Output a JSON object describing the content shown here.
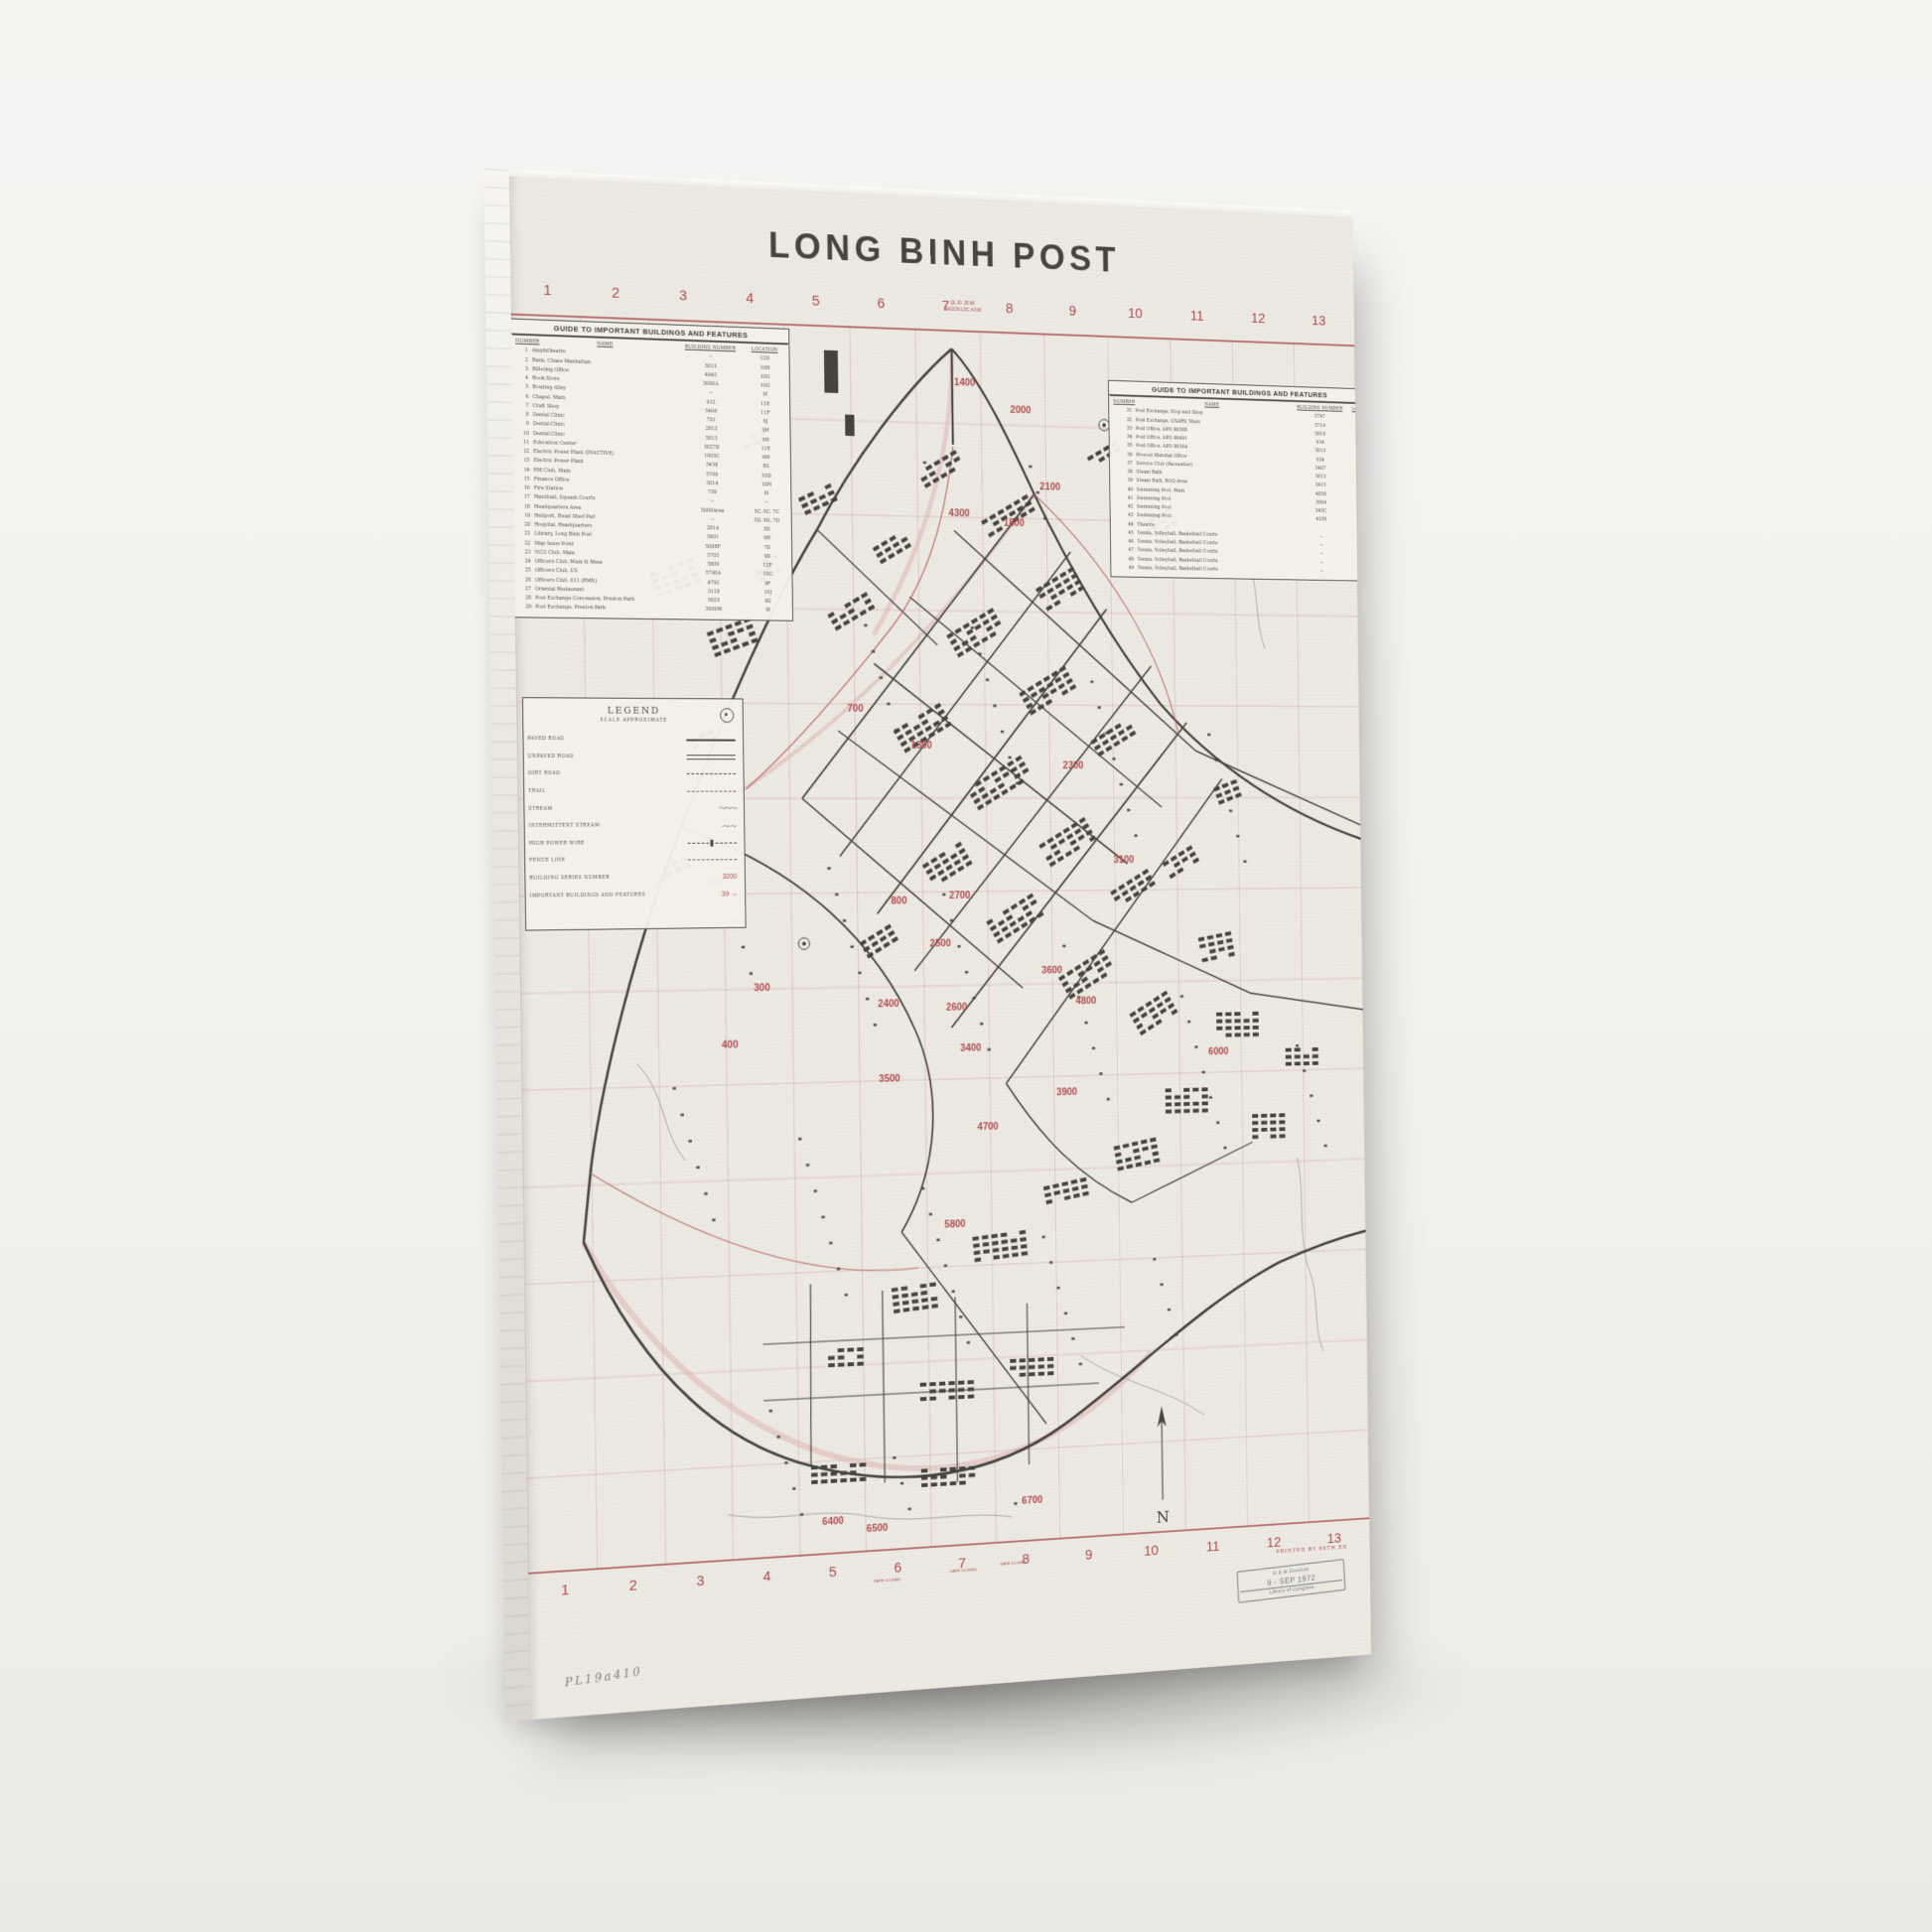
{
  "colors": {
    "paper": "#edebe3",
    "red": "#a84b50",
    "ink": "#45433e",
    "background": "#f2f2f0",
    "stamp_ink": "#5b626b"
  },
  "poster": {
    "title": "LONG BINH POST",
    "grid_numbers_top": [
      "1",
      "2",
      "3",
      "4",
      "5",
      "6",
      "7",
      "8",
      "9",
      "10",
      "11",
      "12",
      "13"
    ],
    "grid_numbers_bottom": [
      "1",
      "2",
      "3",
      "4",
      "5",
      "6",
      "7",
      "8",
      "9",
      "10",
      "11",
      "12",
      "13"
    ],
    "guide_left": {
      "title": "GUIDE TO IMPORTANT BUILDINGS AND FEATURES",
      "columns": [
        "NUMBER",
        "NAME",
        "BUILDING NUMBER",
        "LOCATION"
      ],
      "rows": [
        [
          "1",
          "Amphitheatre",
          "--",
          "12D"
        ],
        [
          "2",
          "Bank, Chase Manhattan",
          "3013",
          "10H"
        ],
        [
          "3",
          "Billeting Office",
          "4943",
          "10G"
        ],
        [
          "4",
          "Book Store",
          "3000A",
          "10G"
        ],
        [
          "5",
          "Bowling Alley",
          "--",
          "9I"
        ],
        [
          "6",
          "Chapel, Main",
          "912",
          "11E"
        ],
        [
          "7",
          "Craft Shop",
          "5406",
          "11F"
        ],
        [
          "8",
          "Dental Clinic",
          "701",
          "6J"
        ],
        [
          "9",
          "Dental Clinic",
          "2813",
          "9H"
        ],
        [
          "10",
          "Dental Clinic",
          "5813",
          "9H"
        ],
        [
          "11",
          "Education Center",
          "3027D",
          "11E"
        ],
        [
          "12",
          "Electric Power Plant (INACTIVE)",
          "1603C",
          "9M"
        ],
        [
          "13",
          "Electric Power Plant",
          "3438",
          "8G"
        ],
        [
          "14",
          "EM Club, Main",
          "5709",
          "10D"
        ],
        [
          "15",
          "Finance Office",
          "3014",
          "10H"
        ],
        [
          "16",
          "Fire Station",
          "739",
          "6I"
        ],
        [
          "17",
          "Handball, Squash Courts",
          "--",
          "--"
        ],
        [
          "18",
          "Headquarters Area",
          "5000Area",
          "5C, 6C, 7C"
        ],
        [
          "19",
          "Heliport, Head Shed Pad",
          "--",
          "5D, 6D, 7D"
        ],
        [
          "20",
          "Hospital, Headquarters",
          "2814",
          "5D"
        ],
        [
          "21",
          "Library, Long Binh Post",
          "5801",
          "9H"
        ],
        [
          "22",
          "Map Issue Point",
          "5008F",
          "7D"
        ],
        [
          "23",
          "NCO Club, Main",
          "5705",
          "9D"
        ],
        [
          "24",
          "Officers Club, Main & Mess",
          "5809",
          "12F"
        ],
        [
          "25",
          "Officers Club, US",
          "5745A",
          "10C"
        ],
        [
          "26",
          "Officers Club, 011 (RMK)",
          "4792",
          "9F"
        ],
        [
          "27",
          "Oriental Restaurant",
          "3118",
          "16J"
        ],
        [
          "28",
          "Post Exchange Concession, Preston Park",
          "5653",
          "9G"
        ],
        [
          "29",
          "Post Exchange, Preston Park",
          "3000M",
          "9I"
        ]
      ]
    },
    "guide_right": {
      "title": "GUIDE TO IMPORTANT BUILDINGS AND FEATURES",
      "columns": [
        "NUMBER",
        "NAME",
        "BUILDING NUMBER",
        "LOCATION"
      ],
      "rows": [
        [
          "31",
          "Post Exchange, Stop and Shop",
          "5747",
          ""
        ],
        [
          "32",
          "Post Exchange, USARV, Main",
          "5714",
          ""
        ],
        [
          "33",
          "Post Office, APO 96388",
          "5810",
          ""
        ],
        [
          "34",
          "Post Office, APO 96491",
          "914",
          ""
        ],
        [
          "35",
          "Post Office, APO 96364",
          "3013",
          ""
        ],
        [
          "36",
          "Provost Marshal Office",
          "634",
          ""
        ],
        [
          "37",
          "Service Club (Pacesetter)",
          "5407",
          ""
        ],
        [
          "38",
          "Steam Bath",
          "5615",
          ""
        ],
        [
          "39",
          "Steam Bath, BOQ Area",
          "5415",
          ""
        ],
        [
          "40",
          "Swimming Pool, Main",
          "4938",
          ""
        ],
        [
          "41",
          "Swimming Pool",
          "3004",
          ""
        ],
        [
          "42",
          "Swimming Pool",
          "343C",
          ""
        ],
        [
          "43",
          "Swimming Pool",
          "4339",
          ""
        ],
        [
          "44",
          "Theatre",
          "",
          ""
        ],
        [
          "45",
          "Tennis, Volleyball, Basketball Courts",
          "--",
          ""
        ],
        [
          "46",
          "Tennis, Volleyball, Basketball Courts",
          "--",
          ""
        ],
        [
          "47",
          "Tennis, Volleyball, Basketball Courts",
          "--",
          ""
        ],
        [
          "48",
          "Tennis, Volleyball, Basketball Courts",
          "--",
          ""
        ],
        [
          "49",
          "Tennis, Volleyball, Basketball Courts",
          "--",
          ""
        ]
      ]
    },
    "legend": {
      "title": "LEGEND",
      "subtitle": "SCALE APPROXIMATE",
      "items": [
        {
          "label": "PAVED ROAD",
          "symbol": "solid"
        },
        {
          "label": "UNPAVED ROAD",
          "symbol": "double"
        },
        {
          "label": "DIRT ROAD",
          "symbol": "dash"
        },
        {
          "label": "TRAIL",
          "symbol": "finedash"
        },
        {
          "label": "STREAM",
          "symbol": "wavy"
        },
        {
          "label": "INTERMITTENT STREAM",
          "symbol": "dashwavy"
        },
        {
          "label": "HIGH POWER WIRE",
          "symbol": "dashbar"
        },
        {
          "label": "FENCE LINE",
          "symbol": "finedash"
        },
        {
          "label": "BUILDING SERIES NUMBER",
          "symbol": "red-number"
        },
        {
          "label": "IMPORTANT BUILDINGS AND FEATURES",
          "symbol": "red-arrow"
        }
      ],
      "red_number_sample": "3200",
      "red_arrow_sample": "39 →"
    },
    "map": {
      "series_numbers": [
        "1400",
        "2000",
        "2100",
        "4300",
        "1800",
        "700",
        "1300",
        "2300",
        "3100",
        "3200",
        "800",
        "2700",
        "2500",
        "2400",
        "2600",
        "3400",
        "3500",
        "3600",
        "4800",
        "3900",
        "4700",
        "300",
        "400",
        "6000",
        "5800",
        "6400",
        "6500",
        "6700"
      ],
      "gate_labels": [
        "GATE CLOSED",
        "GATE CLOSED",
        "GATE CLOSED"
      ],
      "compass": "N",
      "note_lines": [
        "QL 20 .25 MI",
        "SAIGON LOC 43 MI"
      ],
      "printed_by": "PRINTED BY 66TH EN"
    },
    "stamp": {
      "line1": "G & M Division",
      "line2": "9 - SEP 1972",
      "line3": "Library of Congress"
    },
    "handwritten": "PL19a410"
  }
}
